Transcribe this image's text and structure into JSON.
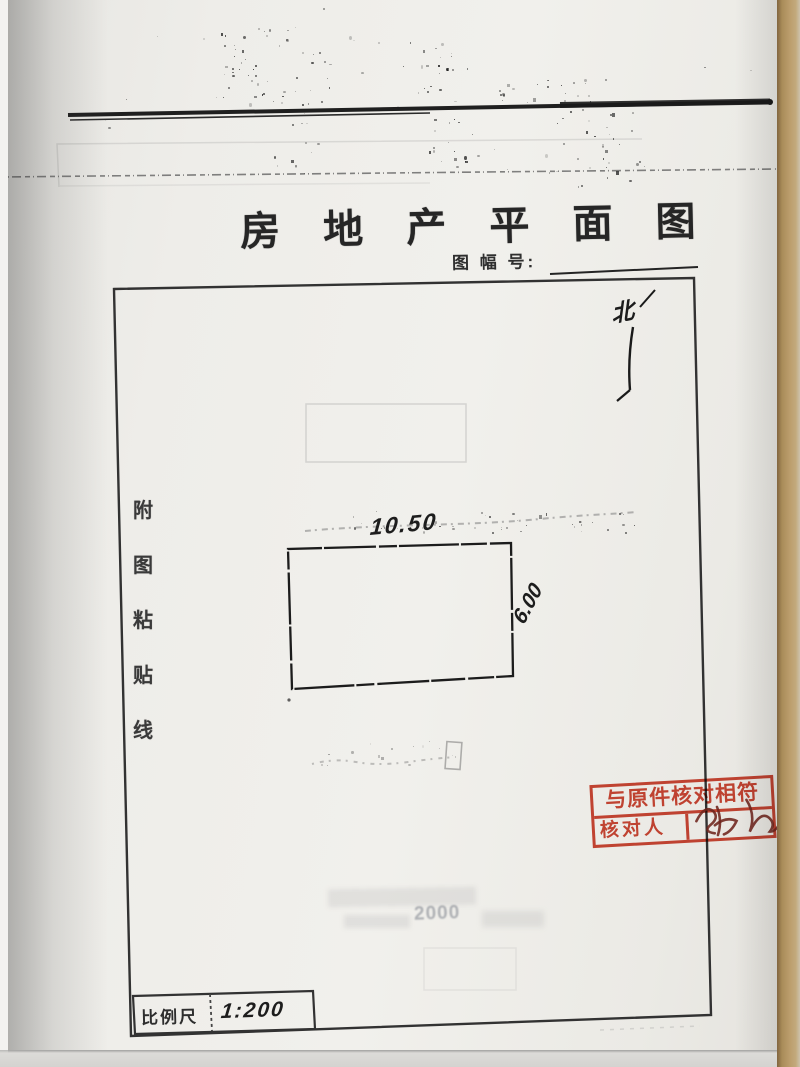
{
  "page": {
    "title": "房 地 产 平 面 图",
    "sheet_label": "图 幅 号:",
    "north_mark": "北",
    "paste_line": [
      "附",
      "图",
      "粘",
      "贴",
      "线"
    ],
    "plot": {
      "top_dimension": "10.50",
      "right_dimension": "6.00"
    },
    "stamp": {
      "line1": "与原件核对相符",
      "verifier_label": "核对人",
      "signature": "张"
    },
    "scale": {
      "label": "比例尺",
      "value": "1:200"
    },
    "bleed_text": "2000"
  },
  "colors": {
    "paper": "#efeeea",
    "ink": "#2b2b2b",
    "stamp_red": "#cc3a26",
    "signature_ink": "#6e241c",
    "desk_tan": "#b6996a"
  }
}
